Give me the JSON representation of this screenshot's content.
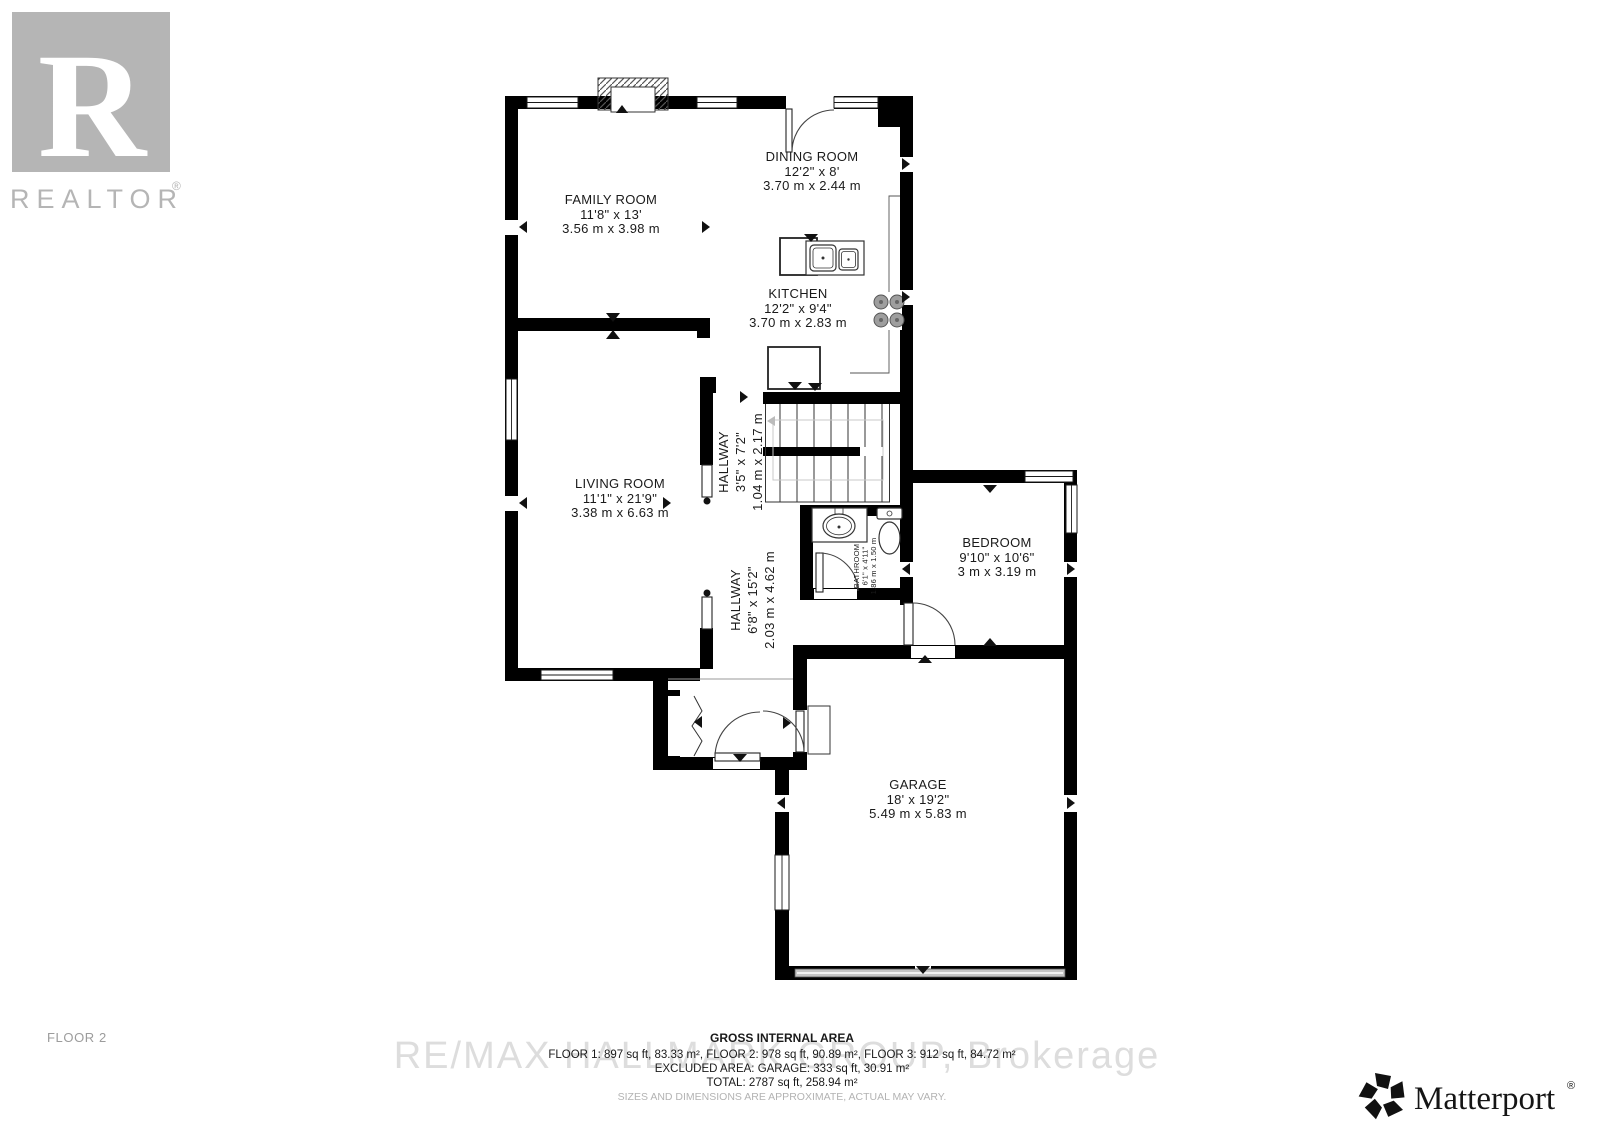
{
  "floor_label": "FLOOR 2",
  "branding": {
    "realtor": {
      "r": "R",
      "name": "REALTOR",
      "reg": "®"
    },
    "matterport": {
      "name": "Matterport",
      "reg": "®"
    },
    "watermark": "RE/MAX HALLMARK GROUP, Brokerage"
  },
  "rooms": [
    {
      "name": "FAMILY ROOM",
      "imperial": "11'8\" x 13'",
      "metric": "3.56 m x 3.98 m"
    },
    {
      "name": "DINING ROOM",
      "imperial": "12'2\" x 8'",
      "metric": "3.70 m x 2.44 m"
    },
    {
      "name": "KITCHEN",
      "imperial": "12'2\" x 9'4\"",
      "metric": "3.70 m x 2.83 m"
    },
    {
      "name": "LIVING ROOM",
      "imperial": "11'1\" x 21'9\"",
      "metric": "3.38 m x 6.63 m"
    },
    {
      "name": "HALLWAY",
      "imperial": "3'5\" x 7'2\"",
      "metric": "1.04 m x 2.17 m"
    },
    {
      "name": "HALLWAY",
      "imperial": "6'8\" x 15'2\"",
      "metric": "2.03 m x 4.62 m"
    },
    {
      "name": "BATHROOM",
      "imperial": "6'1\" x 4'11\"",
      "metric": "1.86 m x 1.50 m"
    },
    {
      "name": "BEDROOM",
      "imperial": "9'10\" x 10'6\"",
      "metric": "3 m x 3.19 m"
    },
    {
      "name": "GARAGE",
      "imperial": "18' x 19'2\"",
      "metric": "5.49 m x 5.83 m"
    }
  ],
  "area_summary": {
    "title": "GROSS INTERNAL AREA",
    "floors": "FLOOR 1: 897 sq ft, 83.33 m², FLOOR 2: 978 sq ft, 90.89 m², FLOOR 3: 912 sq ft, 84.72 m²",
    "excluded": "EXCLUDED AREA: GARAGE: 333 sq ft, 30.91 m²",
    "total": "TOTAL: 2787 sq ft, 258.94 m²",
    "disclaimer": "SIZES AND DIMENSIONS ARE APPROXIMATE, ACTUAL MAY VARY."
  },
  "colors": {
    "wall": "#000000",
    "text": "#1a1a1a",
    "logo_gray": "#b5b5b5",
    "watermark_gray": "#dddddd",
    "garage_door_gray": "#c4c4c4"
  }
}
